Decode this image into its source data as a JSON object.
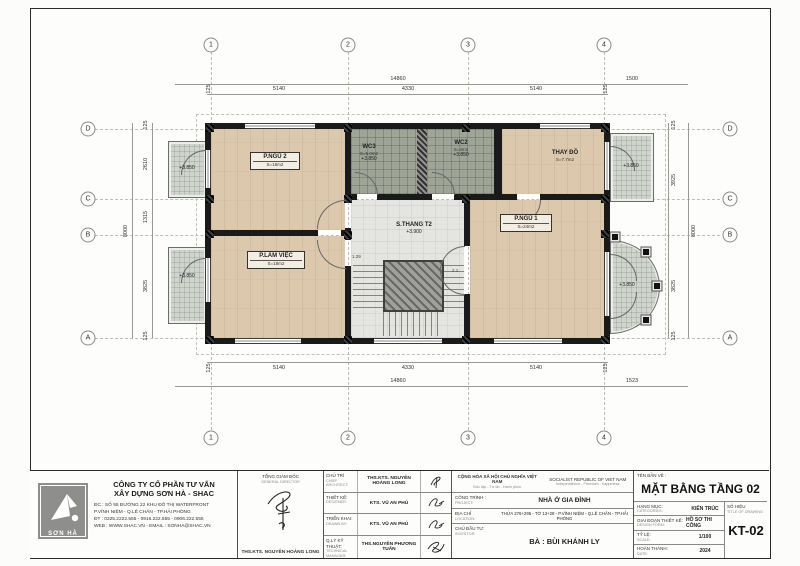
{
  "colors": {
    "wood_floor": "#dcc9ad",
    "wc_tile": "#9ea596",
    "landing": "#e4e4e1",
    "wall": "#1a1a1a",
    "balcony": "#cfd4cd"
  },
  "plan": {
    "grid_cols": [
      "1",
      "2",
      "3",
      "4"
    ],
    "grid_rows": [
      "D",
      "C",
      "B",
      "A"
    ],
    "dims": {
      "top_overall": "14860",
      "top_right": "1500",
      "top_segments": [
        "125",
        "5140",
        "4330",
        "5140",
        "125"
      ],
      "bottom_segments": [
        "125",
        "5140",
        "4330",
        "5140",
        "125"
      ],
      "bottom_overall": "14860",
      "bottom_right": "1523",
      "left_segments": [
        "125",
        "2610",
        "1315",
        "3825",
        "125"
      ],
      "left_overall": "8000",
      "right_segments": [
        "125",
        "3925",
        "3825",
        "125"
      ],
      "right_overall": "8000"
    },
    "rooms": {
      "pngu2": {
        "name": "P.NGỦ 2",
        "area": "S=18m2"
      },
      "plamviec": {
        "name": "P.LÀM VIỆC",
        "area": "S=18m2"
      },
      "pngu1": {
        "name": "P.NGỦ 1",
        "area": "S=24m2"
      },
      "wc3": {
        "name": "WC3",
        "area": "S=5.0m2",
        "level": "+3.850"
      },
      "wc2": {
        "name": "WC2",
        "area": "S=4m2",
        "level": "+3.850"
      },
      "thaydo": {
        "name": "THAY ĐỒ",
        "area": "S=7.7m2"
      },
      "stair": {
        "name": "S.THANG T2",
        "level": "+3.900"
      }
    },
    "balcony_level": "+3.850",
    "notes": {
      "n1": "1.29",
      "n2": "2.1"
    }
  },
  "title_block": {
    "company": {
      "logo_text": "SƠN HÀ",
      "name1": "CÔNG TY CỔ PHẦN TƯ VẤN",
      "name2": "XÂY DỰNG SƠN HÀ - SHAC",
      "addr1": "ĐC : SỐ 55 ĐƯỜNG 22 KHU ĐÔ THỊ WATERFRONT",
      "addr2": "P.VĨNH NIỆM - Q.LÊ CHÂN - TP.HẢI PHÒNG",
      "phone": "ĐT : 0225.2222.555 - 0916.222.555 - 0906.222.555",
      "web": "WEB : WWW.SHAC.VN - EMAIL : SONHA@SHAC.VN"
    },
    "director": {
      "label": "TỔNG GIÁM ĐỐC",
      "sublabel": "GENERAL DIRECTOR",
      "name": "THS.KTS. NGUYỄN HOÀNG LONG"
    },
    "roles": [
      {
        "label": "CHỦ TRÌ",
        "sublabel": "CHIEF ARCHITECT:",
        "name": "THS.KTS. NGUYỄN HOÀNG LONG"
      },
      {
        "label": "THIẾT KẾ:",
        "sublabel": "DESIGNER:",
        "name": "KTS. VŨ AN PHÚ"
      },
      {
        "label": "TRIỂN KHAI:",
        "sublabel": "DRAWN BY:",
        "name": "KTS. VŨ AN PHÚ"
      },
      {
        "label": "Q.LÝ KỸ THUẬT:",
        "sublabel": "TECHNICAL MANAGER:",
        "name": "THS.NGUYỄN PHƯƠNG TUẤN"
      }
    ],
    "nation": {
      "vn1": "CỘNG HÒA XÃ HỘI CHỦ NGHĨA VIỆT NAM",
      "vn2": "Độc lập - Tự do - Hạnh phúc",
      "en1": "SOCIALIST REPUBLIC OF VIET NAM",
      "en2": "Independence - Freedom - happiness"
    },
    "project": {
      "label": "CÔNG TRÌNH :",
      "sublabel": "PROJECT:",
      "value": "NHÀ Ở GIA ĐÌNH",
      "addr_label": "ĐỊA CHỈ",
      "addr_sublabel": "LOCATION:",
      "addr_value": "THỬA 276+295 - TỜ 13+28 - P.VĨNH NIỆM - Q.LÊ CHÂN - TP.HẢI PHÒNG",
      "inv_label": "CHỦ ĐẦU TƯ:",
      "inv_sublabel": "INVESTOR:",
      "inv_value": "BÀ : BÙI KHÁNH LY"
    },
    "drawing": {
      "ten_ban_ve": "TÊN BẢN VẼ :",
      "title": "MẶT BẰNG TẦNG 02",
      "rows": [
        {
          "label": "HẠNG MỤC:",
          "sublabel": "CATEGORIES:",
          "value": "KIẾN TRÚC"
        },
        {
          "label": "GIAI ĐOẠN THIẾT KẾ:",
          "sublabel": "DESIGN FORM:",
          "value": "HỒ SƠ THI CÔNG"
        },
        {
          "label": "TỶ LỆ:",
          "sublabel": "SCALE:",
          "value": "1/100"
        },
        {
          "label": "HOÀN THÀNH:",
          "sublabel": "DATE:",
          "value": "2024"
        }
      ],
      "so_hieu_label": "SỐ HIỆU",
      "so_hieu_sublabel": "TITLE OF DRAWING",
      "number": "KT-02"
    }
  }
}
